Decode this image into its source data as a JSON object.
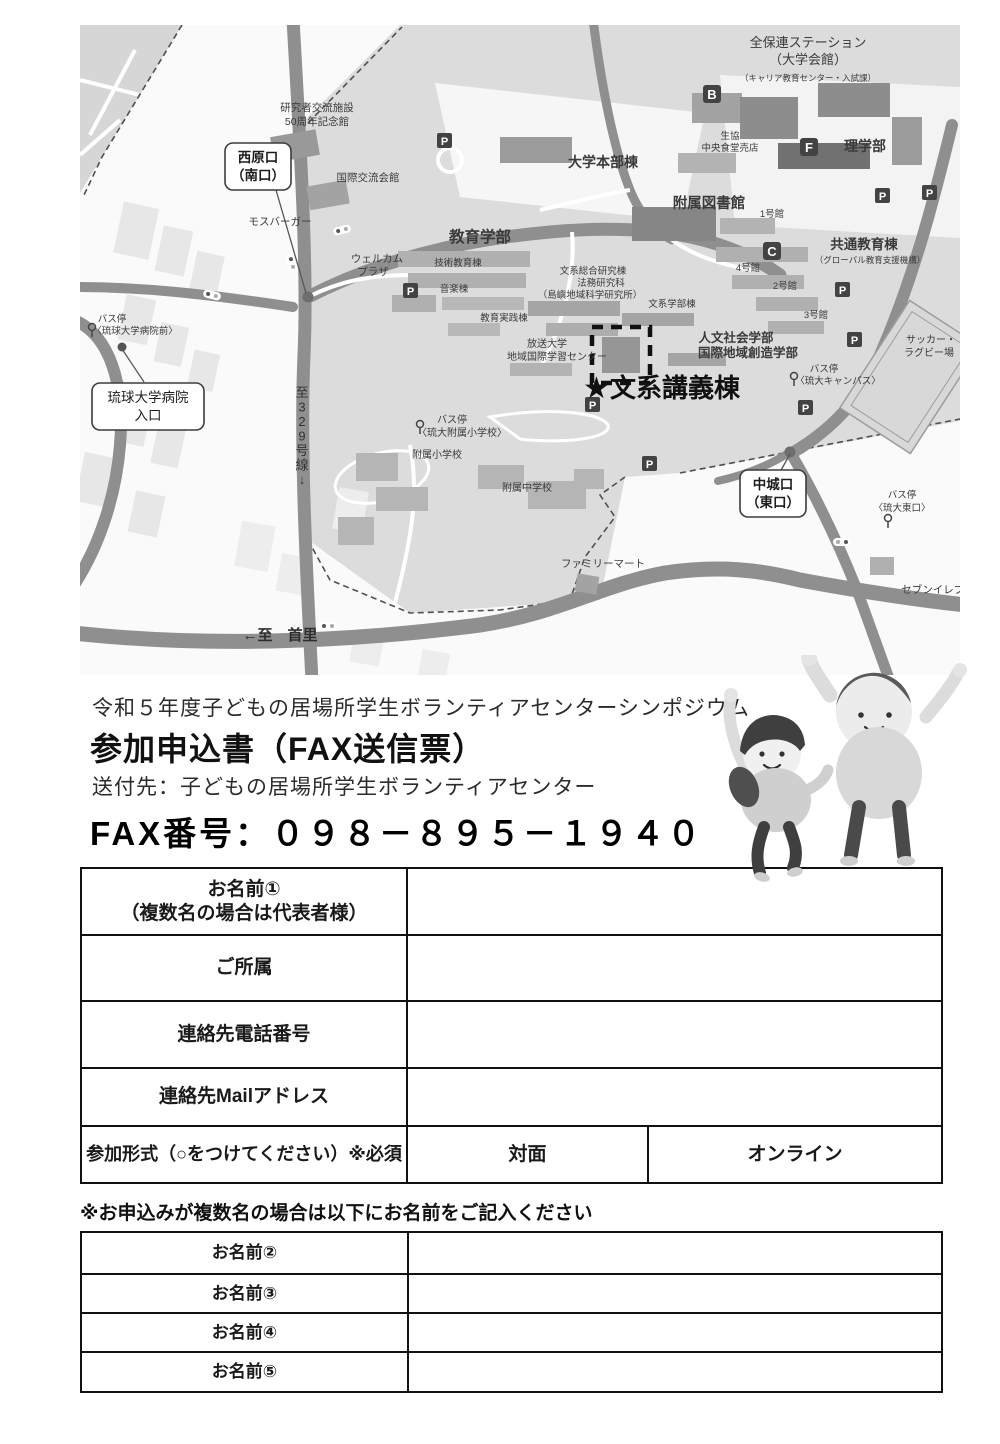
{
  "header": {
    "event_line": "令和５年度子どもの居場所学生ボランティアセンターシンポジウム",
    "title": "参加申込書（FAX送信票）",
    "recipient": "送付先：子どもの居場所学生ボランティアセンター",
    "fax": "FAX番号：０９８－８９５－１９４０"
  },
  "form1": {
    "rows": [
      {
        "lines": [
          "お名前①",
          "（複数名の場合は代表者様）"
        ]
      },
      {
        "label": "ご所属"
      },
      {
        "label": "連絡先電話番号"
      },
      {
        "label": "連絡先Mailアドレス"
      },
      {
        "label": "参加形式（○をつけてください）※必須",
        "options": [
          "対面",
          "オンライン"
        ]
      }
    ]
  },
  "note": "※お申込みが複数名の場合は以下にお名前をご記入ください",
  "names_table": {
    "rows": [
      "お名前②",
      "お名前③",
      "お名前④",
      "お名前⑤"
    ]
  },
  "map": {
    "colors": {
      "road": "#8f8f8f",
      "campus": "#dcdcdc",
      "marker": "#434343",
      "label": "#3a3a3a"
    },
    "venue": {
      "star": "★",
      "label": "文系講義棟"
    },
    "labels": [
      {
        "t": "全保連ステーション",
        "x": 728,
        "y": 22,
        "s": 13
      },
      {
        "t": "（大学会館）",
        "x": 728,
        "y": 39,
        "s": 13
      },
      {
        "t": "（キャリア教育センター・入試課）",
        "x": 728,
        "y": 56,
        "s": 8.5
      },
      {
        "t": "理学部",
        "x": 785,
        "y": 126,
        "s": 14,
        "b": 1
      },
      {
        "t": "生協",
        "x": 650,
        "y": 114,
        "s": 9.5
      },
      {
        "t": "中央食堂売店",
        "x": 650,
        "y": 126,
        "s": 9.5
      },
      {
        "t": "研究者交流施設",
        "x": 237,
        "y": 86,
        "s": 10.5
      },
      {
        "t": "50周年記念館",
        "x": 237,
        "y": 100,
        "s": 10.5
      },
      {
        "t": "国際交流会館",
        "x": 288,
        "y": 156,
        "s": 10.5
      },
      {
        "t": "大学本部棟",
        "x": 523,
        "y": 142,
        "s": 14,
        "b": 1
      },
      {
        "t": "附属図書館",
        "x": 629,
        "y": 183,
        "s": 14.5,
        "b": 1
      },
      {
        "t": "1号館",
        "x": 692,
        "y": 192,
        "s": 9.5
      },
      {
        "t": "モスバーガー",
        "x": 200,
        "y": 200,
        "s": 10.5
      },
      {
        "t": "教育学部",
        "x": 400,
        "y": 217,
        "s": 15.5,
        "b": 1
      },
      {
        "t": "共通教育棟",
        "x": 784,
        "y": 224,
        "s": 13.5,
        "b": 1
      },
      {
        "t": "（グローバル教育支援機構）",
        "x": 790,
        "y": 238,
        "s": 8.5
      },
      {
        "t": "ウェルカム",
        "x": 297,
        "y": 237,
        "s": 10.5
      },
      {
        "t": "プラザ",
        "x": 293,
        "y": 250,
        "s": 10.5
      },
      {
        "t": "技術教育棟",
        "x": 378,
        "y": 241,
        "s": 9.5
      },
      {
        "t": "4号館",
        "x": 668,
        "y": 246,
        "s": 9.5
      },
      {
        "t": "音楽棟",
        "x": 374,
        "y": 267,
        "s": 9.5
      },
      {
        "t": "2号館",
        "x": 705,
        "y": 264,
        "s": 9.5
      },
      {
        "t": "文系総合研究棟",
        "x": 513,
        "y": 249,
        "s": 9.5
      },
      {
        "t": "法務研究科",
        "x": 521,
        "y": 261,
        "s": 9.5
      },
      {
        "t": "（島嶼地域科学研究所）",
        "x": 510,
        "y": 273,
        "s": 9.5
      },
      {
        "t": "文系学部棟",
        "x": 592,
        "y": 282,
        "s": 9.5
      },
      {
        "t": "3号館",
        "x": 736,
        "y": 293,
        "s": 9.5
      },
      {
        "t": "教育実践棟",
        "x": 424,
        "y": 296,
        "s": 9.5
      },
      {
        "t": "バス停",
        "x": 32,
        "y": 297,
        "s": 9.5
      },
      {
        "t": "〈琉球大学病院前〉",
        "x": 55,
        "y": 309,
        "s": 9.5
      },
      {
        "t": "人文社会学部",
        "x": 656,
        "y": 317,
        "s": 12.5,
        "b": 1
      },
      {
        "t": "国際地域創造学部",
        "x": 668,
        "y": 332,
        "s": 12.5,
        "b": 1
      },
      {
        "t": "放送大学",
        "x": 467,
        "y": 322,
        "s": 10
      },
      {
        "t": "地域国際学習センター",
        "x": 477,
        "y": 335,
        "s": 10
      },
      {
        "t": "サッカー・",
        "x": 851,
        "y": 318,
        "s": 10
      },
      {
        "t": "ラグビー場",
        "x": 849,
        "y": 331,
        "s": 10
      },
      {
        "t": "バス停",
        "x": 744,
        "y": 347,
        "s": 9.5
      },
      {
        "t": "〈琉大キャンパス〉",
        "x": 758,
        "y": 359,
        "s": 9.5
      },
      {
        "t": "バス停",
        "x": 372,
        "y": 398,
        "s": 10
      },
      {
        "t": "〈琉大附属小学校〉",
        "x": 382,
        "y": 411,
        "s": 10
      },
      {
        "t": "附属小学校",
        "x": 357,
        "y": 433,
        "s": 10
      },
      {
        "t": "附属中学校",
        "x": 447,
        "y": 466,
        "s": 10
      },
      {
        "t": "バス停",
        "x": 822,
        "y": 473,
        "s": 9.5
      },
      {
        "t": "〈琉大東口〉",
        "x": 822,
        "y": 486,
        "s": 9.5
      },
      {
        "t": "ファミリーマート",
        "x": 523,
        "y": 542,
        "s": 10.5
      },
      {
        "t": "セブンイレブン",
        "x": 858,
        "y": 568,
        "s": 10.5
      },
      {
        "t": "←至　首里",
        "x": 200,
        "y": 615,
        "s": 15,
        "b": 1,
        "c": "#2e2e2e"
      },
      {
        "t": "至329号線↓",
        "x": 222,
        "y": 372,
        "s": 13,
        "vert": 1,
        "c": "#333333"
      }
    ],
    "boxed_labels": [
      {
        "lines": [
          "西原口",
          "（南口）"
        ],
        "x": 145,
        "y": 118,
        "w": 66,
        "h": 47,
        "b": 1
      },
      {
        "lines": [
          "琉球大学病院",
          "入口"
        ],
        "x": 12,
        "y": 358,
        "w": 112,
        "h": 47,
        "b": 0
      },
      {
        "lines": [
          "中城口",
          "（東口）"
        ],
        "x": 660,
        "y": 445,
        "w": 66,
        "h": 47,
        "b": 1
      }
    ],
    "parking_letter": "P",
    "parking": [
      {
        "x": 357,
        "y": 108
      },
      {
        "x": 323,
        "y": 258
      },
      {
        "x": 795,
        "y": 163
      },
      {
        "x": 842,
        "y": 160
      },
      {
        "x": 755,
        "y": 257
      },
      {
        "x": 767,
        "y": 307
      },
      {
        "x": 718,
        "y": 375
      },
      {
        "x": 505,
        "y": 372
      },
      {
        "x": 562,
        "y": 431
      }
    ],
    "lettered": [
      {
        "letter": "B",
        "x": 623,
        "y": 60
      },
      {
        "letter": "C",
        "x": 683,
        "y": 217
      },
      {
        "letter": "F",
        "x": 720,
        "y": 113
      }
    ],
    "bus_stops": [
      {
        "x": 12,
        "y": 302
      },
      {
        "x": 714,
        "y": 351
      },
      {
        "x": 340,
        "y": 399
      },
      {
        "x": 808,
        "y": 493
      }
    ]
  }
}
